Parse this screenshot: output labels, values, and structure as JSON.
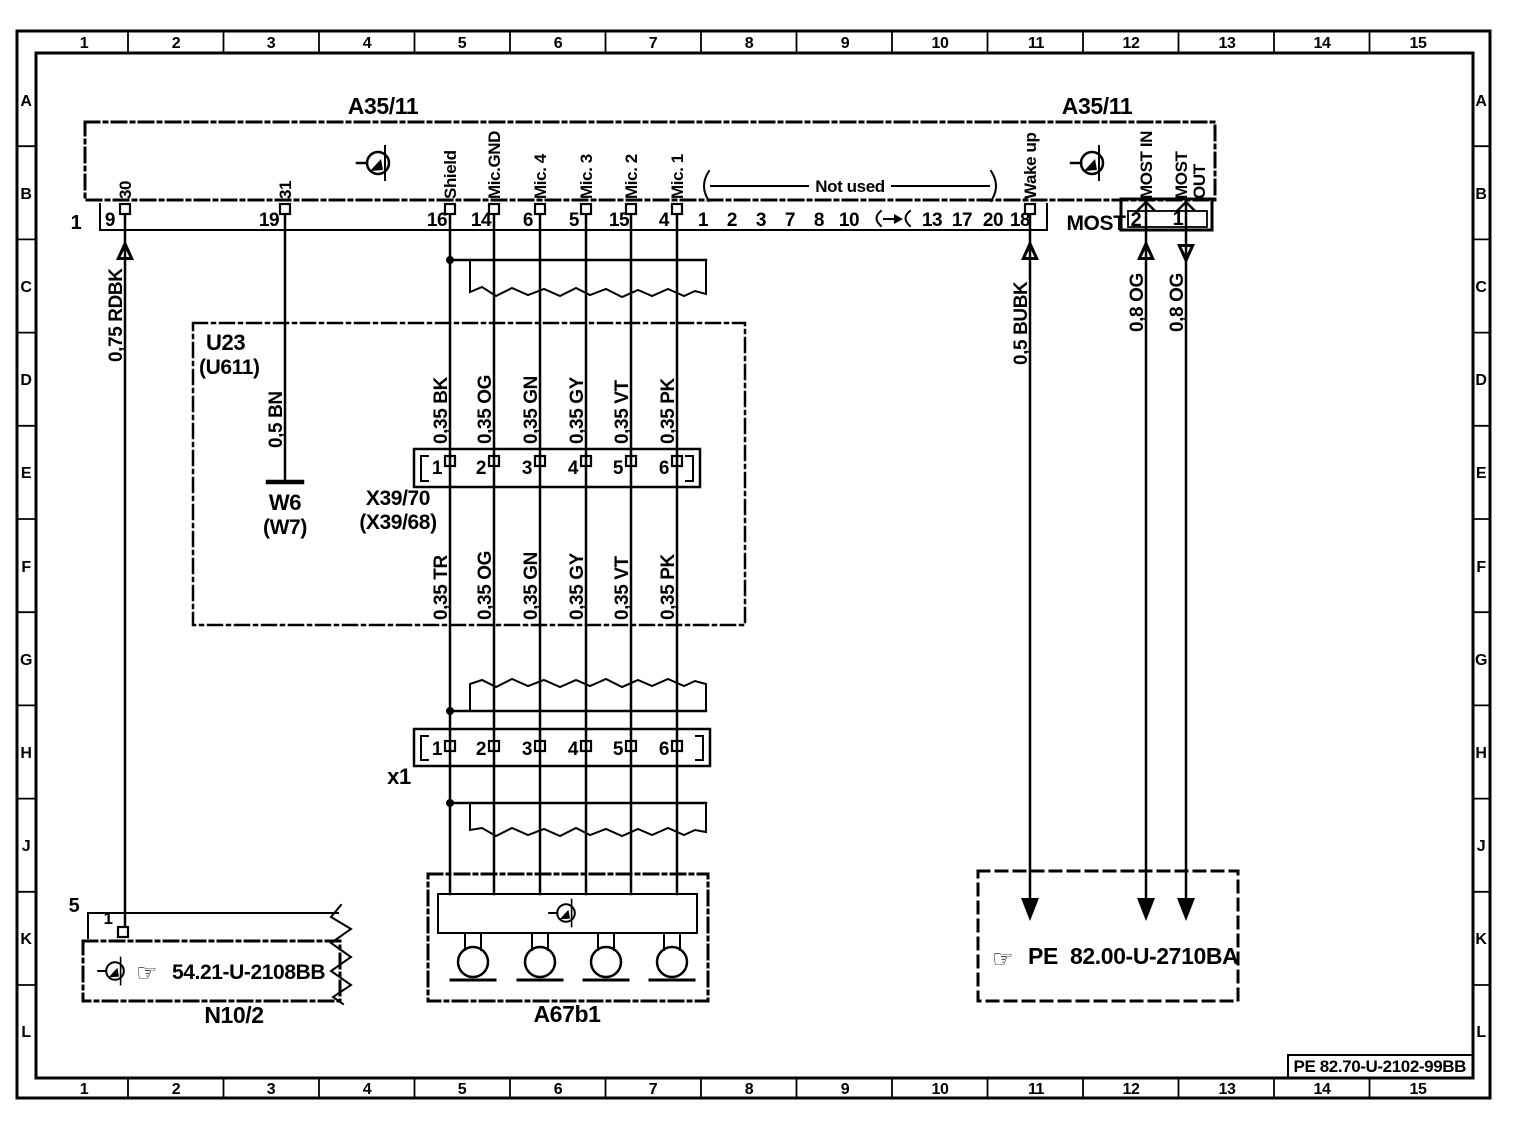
{
  "border": {
    "columns": [
      "1",
      "2",
      "3",
      "4",
      "5",
      "6",
      "7",
      "8",
      "9",
      "10",
      "11",
      "12",
      "13",
      "14",
      "15"
    ],
    "rows": [
      "A",
      "B",
      "C",
      "D",
      "E",
      "F",
      "G",
      "H",
      "J",
      "K",
      "L"
    ]
  },
  "diagram": {
    "module_label_left": "A35/11",
    "module_label_right": "A35/11",
    "connector1_label": "1",
    "not_used": "Not used",
    "most": "MOST",
    "most_pin_2": "2",
    "most_pin_1": "1",
    "strip_pins": [
      "9",
      "19",
      "16",
      "14",
      "6",
      "5",
      "15",
      "4",
      "1",
      "2",
      "3",
      "7",
      "8",
      "10",
      "13",
      "17",
      "20",
      "18"
    ],
    "signal_labels": [
      "30",
      "31",
      "Shield",
      "Mic.GND",
      "Mic. 4",
      "Mic. 3",
      "Mic. 2",
      "Mic. 1",
      "Wake up",
      "MOST IN",
      "MOST",
      "OUT"
    ],
    "wire_labels": [
      "0,75 RDBK",
      "0,5 BN",
      "0,35 BK",
      "0,35 OG",
      "0,35 GN",
      "0,35 GY",
      "0,35 VT",
      "0,35 PK",
      "0,35 TR",
      "0,35 OG",
      "0,35 GN",
      "0,35 GY",
      "0,35 VT",
      "0,35 PK",
      "0,5 BUBK",
      "0,8 OG",
      "0,8 OG"
    ],
    "u23": {
      "name": "U23",
      "alt_name": "(U611)"
    },
    "w6": {
      "name": "W6",
      "alt_name": "(W7)"
    },
    "x39": {
      "name": "X39/70",
      "alt_name": "(X39/68)",
      "pins": [
        "1",
        "2",
        "3",
        "4",
        "5",
        "6"
      ]
    },
    "x1": {
      "name": "x1",
      "pins": [
        "1",
        "2",
        "3",
        "4",
        "5",
        "6"
      ]
    },
    "a67b1": {
      "name": "A67b1"
    },
    "n10_2": {
      "name": "N10/2",
      "strip_label": "5",
      "pin": "1",
      "pointer": "☞",
      "ref": "54.21-U-2108BB"
    },
    "pe": {
      "pointer": "☞",
      "label": "PE",
      "ref": "82.00-U-2710BA"
    },
    "drawing_ref": "PE 82.70-U-2102-99BB"
  }
}
